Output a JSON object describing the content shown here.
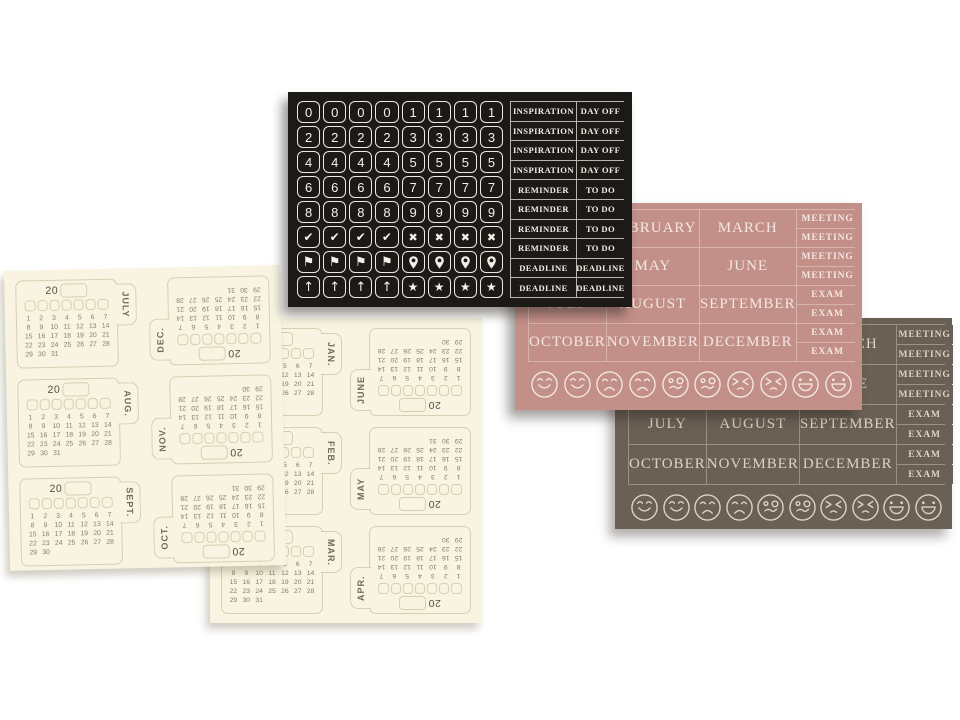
{
  "page": {
    "background": "#ffffff"
  },
  "black_sheet": {
    "bg": "#1b1a17",
    "ink": "#f1ede4",
    "tile_border": "#edeae1",
    "grid_line": "#b9b5aa",
    "tile_rows": [
      [
        "0",
        "0",
        "0",
        "0",
        "1",
        "1",
        "1",
        "1"
      ],
      [
        "2",
        "2",
        "2",
        "2",
        "3",
        "3",
        "3",
        "3"
      ],
      [
        "4",
        "4",
        "4",
        "4",
        "5",
        "5",
        "5",
        "5"
      ],
      [
        "6",
        "6",
        "6",
        "6",
        "7",
        "7",
        "7",
        "7"
      ],
      [
        "8",
        "8",
        "8",
        "8",
        "9",
        "9",
        "9",
        "9"
      ],
      [
        "check",
        "check",
        "check",
        "check",
        "x",
        "x",
        "x",
        "x"
      ],
      [
        "flag",
        "flag",
        "flag",
        "flag",
        "pin",
        "pin",
        "pin",
        "pin"
      ],
      [
        "arrow-up",
        "arrow-up",
        "arrow-up",
        "arrow-up",
        "star",
        "star",
        "star",
        "star"
      ]
    ],
    "label_rows": [
      [
        "INSPIRATION",
        "DAY OFF"
      ],
      [
        "INSPIRATION",
        "DAY OFF"
      ],
      [
        "INSPIRATION",
        "DAY OFF"
      ],
      [
        "INSPIRATION",
        "DAY OFF"
      ],
      [
        "REMINDER",
        "TO DO"
      ],
      [
        "REMINDER",
        "TO DO"
      ],
      [
        "REMINDER",
        "TO DO"
      ],
      [
        "REMINDER",
        "TO DO"
      ],
      [
        "DEADLINE",
        "DEADLINE"
      ],
      [
        "DEADLINE",
        "DEADLINE"
      ]
    ]
  },
  "pink_sheet": {
    "bg": "#c39089",
    "ink": "#f3e7e0",
    "line": "#d7b3ac",
    "month_rows": [
      [
        "JANUARY",
        "FEBRUARY",
        "MARCH"
      ],
      [
        "APRIL",
        "MAY",
        "JUNE"
      ],
      [
        "JULY",
        "AUGUST",
        "SEPTEMBER"
      ],
      [
        "OCTOBER",
        "NOVEMBER",
        "DECEMBER"
      ]
    ],
    "side_labels": [
      "MEETING",
      "MEETING",
      "MEETING",
      "MEETING",
      "EXAM",
      "EXAM",
      "EXAM",
      "EXAM"
    ],
    "emojis": [
      "smile",
      "smile",
      "sad",
      "sad",
      "silly",
      "silly",
      "angry",
      "angry",
      "laugh",
      "laugh"
    ]
  },
  "brown_sheet": {
    "bg": "#6a6156",
    "ink": "#ded3c3",
    "line": "#9c9184",
    "month_rows": [
      [
        "JANUARY",
        "FEBRUARY",
        "MARCH"
      ],
      [
        "APRIL",
        "MAY",
        "JUNE"
      ],
      [
        "JULY",
        "AUGUST",
        "SEPTEMBER"
      ],
      [
        "OCTOBER",
        "NOVEMBER",
        "DECEMBER"
      ]
    ],
    "side_labels": [
      "MEETING",
      "MEETING",
      "MEETING",
      "MEETING",
      "EXAM",
      "EXAM",
      "EXAM",
      "EXAM"
    ],
    "emojis": [
      "smile",
      "smile",
      "sad",
      "sad",
      "silly",
      "silly",
      "angry",
      "angry",
      "laugh",
      "laugh"
    ]
  },
  "cream_sheet_left": {
    "bg": "#f8f4e1",
    "line": "#d5d0b1",
    "ink": "#6f6d57",
    "year_prefix": "20",
    "pairs": [
      {
        "front": {
          "label": "JULY",
          "days": 31
        },
        "back": {
          "label": "DEC.",
          "days": 31
        }
      },
      {
        "front": {
          "label": "AUG.",
          "days": 31
        },
        "back": {
          "label": "NOV.",
          "days": 30
        }
      },
      {
        "front": {
          "label": "SEPT.",
          "days": 30
        },
        "back": {
          "label": "OCT.",
          "days": 31
        }
      }
    ]
  },
  "cream_sheet_center": {
    "bg": "#f8f4e1",
    "line": "#d5d0b1",
    "ink": "#6f6d57",
    "year_prefix": "20",
    "pairs": [
      {
        "front": {
          "label": "JAN.",
          "days": 31
        },
        "back": {
          "back_note": "",
          "label": "JUNE",
          "days": 30
        }
      },
      {
        "front": {
          "label": "FEB.",
          "days": 28
        },
        "back": {
          "label": "MAY",
          "days": 31
        }
      },
      {
        "front": {
          "label": "MAR.",
          "days": 31
        },
        "back": {
          "label": "APR.",
          "days": 30
        }
      }
    ]
  }
}
